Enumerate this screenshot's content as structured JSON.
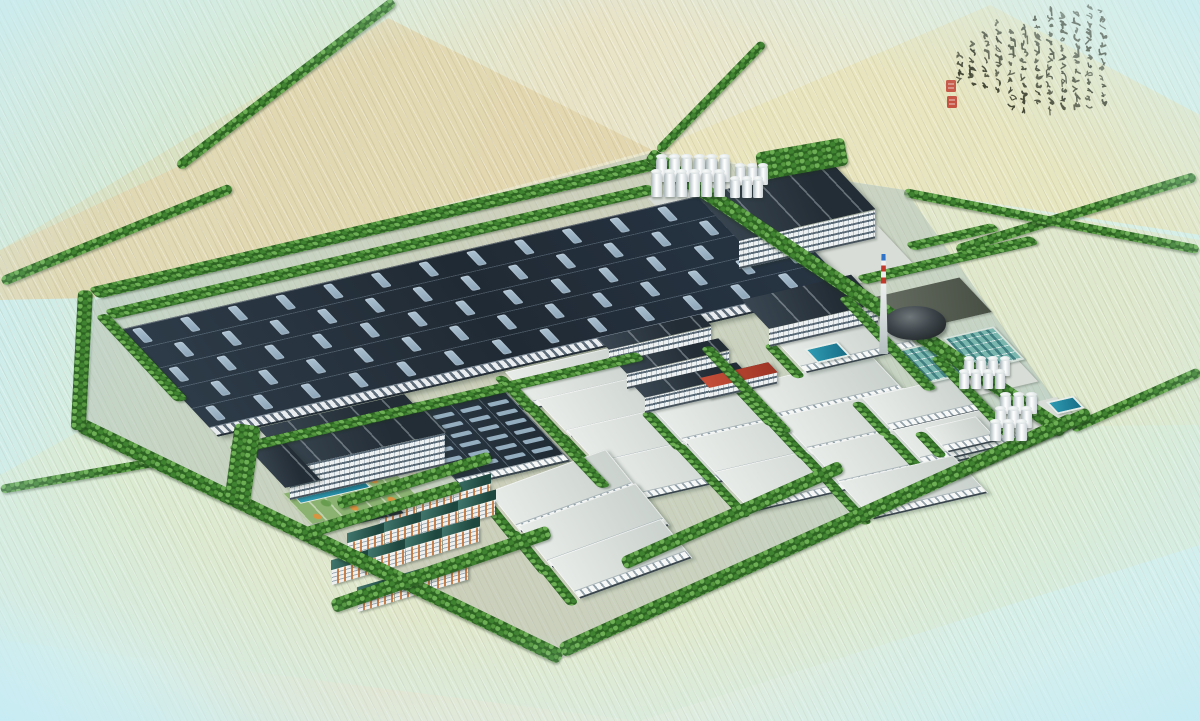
{
  "scene": {
    "title": "Industrial park master-plan aerial rendering",
    "medium": "hand-tinted architectural perspective over hatched farmland",
    "palette": {
      "sky_edge": "#c7ecf3",
      "field_beige": "#e2d5ac",
      "field_green": "#dbead0",
      "tree_light": "#6db054",
      "tree_dark": "#2d6323",
      "roof_dark": "#232d38",
      "skylight": "#9db6c8",
      "roof_light": "#dde2de",
      "wall_white": "#eef1f2",
      "water_teal": "#2f9cb4",
      "basin_teal": "#79b7ae",
      "chimney_red": "#c0392b",
      "chimney_blue": "#2e73c8",
      "accent_red": "#b8432c",
      "residential_roof": "#1e473f",
      "residential_accent": "#c6763a",
      "seal_red": "#c0392b",
      "ink": "#32321e"
    },
    "inscription": {
      "type": "cursive Chinese calligraphy (decorative, illegible)",
      "column_count": 12,
      "seal_count": 2,
      "seal_color": "#c0392b",
      "ink_color": "#32321e"
    }
  },
  "site": {
    "description": "tree-lined industrial plot with radiating field roads",
    "roads": [
      {
        "x": 0,
        "y": 277,
        "w": 248,
        "h": 10,
        "r": -22.2
      },
      {
        "x": 175,
        "y": 163,
        "w": 272,
        "h": 10,
        "r": -37.5
      },
      {
        "x": 955,
        "y": 245,
        "w": 250,
        "h": 10,
        "r": -17
      },
      {
        "x": 905,
        "y": 188,
        "w": 300,
        "h": 9,
        "r": 11
      },
      {
        "x": 1070,
        "y": 424,
        "w": 140,
        "h": 10,
        "r": -24
      },
      {
        "x": 0,
        "y": 485,
        "w": 165,
        "h": 9,
        "r": -10
      },
      {
        "x": 655,
        "y": 148,
        "w": 151,
        "h": 9,
        "r": -45.8
      }
    ],
    "tree_strips": [
      {
        "x": 88,
        "y": 288,
        "w": 578,
        "h": 15,
        "m": "iso"
      },
      {
        "x": 653,
        "y": 148,
        "w": 500,
        "h": 15,
        "r": 33.7
      },
      {
        "x": 558,
        "y": 644,
        "w": 562,
        "h": 15,
        "r": -24.3
      },
      {
        "x": 83,
        "y": 418,
        "w": 535,
        "h": 15,
        "r": 25.8
      },
      {
        "x": 78,
        "y": 290,
        "w": 15,
        "h": 140,
        "r": 3
      },
      {
        "x": 104,
        "y": 310,
        "w": 560,
        "h": 13,
        "m": "iso"
      },
      {
        "x": 95,
        "y": 316,
        "w": 13,
        "h": 120,
        "m": "iso"
      },
      {
        "x": 228,
        "y": 446,
        "w": 420,
        "h": 12,
        "m": "iso"
      },
      {
        "x": 505,
        "y": 388,
        "w": 12,
        "h": 140,
        "m": "iso"
      },
      {
        "x": 838,
        "y": 298,
        "w": 12,
        "h": 130,
        "m": "iso"
      },
      {
        "x": 856,
        "y": 276,
        "w": 180,
        "h": 12,
        "m": "iso"
      },
      {
        "x": 930,
        "y": 358,
        "w": 12,
        "h": 110,
        "m": "iso"
      },
      {
        "x": 950,
        "y": 468,
        "w": 150,
        "h": 13,
        "r": -24
      },
      {
        "x": 620,
        "y": 558,
        "w": 240,
        "h": 13,
        "r": -24
      },
      {
        "x": 336,
        "y": 498,
        "w": 160,
        "h": 12,
        "r": -17
      },
      {
        "x": 330,
        "y": 600,
        "w": 230,
        "h": 14,
        "r": -19
      },
      {
        "x": 700,
        "y": 348,
        "w": 12,
        "h": 120,
        "m": "iso"
      },
      {
        "x": 905,
        "y": 243,
        "w": 90,
        "h": 11,
        "m": "iso"
      },
      {
        "x": 755,
        "y": 153,
        "w": 90,
        "h": 28,
        "r": -10
      },
      {
        "x": 235,
        "y": 423,
        "w": 26,
        "h": 80,
        "r": 8
      },
      {
        "x": 296,
        "y": 530,
        "w": 170,
        "h": 12,
        "r": -17
      }
    ],
    "pads": [
      {
        "x": 648,
        "y": 198,
        "w": 102,
        "h": 40
      },
      {
        "x": 760,
        "y": 252,
        "w": 120,
        "h": 62
      },
      {
        "x": 862,
        "y": 300,
        "w": 100,
        "h": 48,
        "dark": true
      },
      {
        "x": 958,
        "y": 372,
        "w": 60,
        "h": 32
      },
      {
        "x": 992,
        "y": 412,
        "w": 66,
        "h": 36
      }
    ],
    "warehouses": [
      {
        "x": 505,
        "y": 372,
        "w": 130,
        "h": 50,
        "m": "iso"
      },
      {
        "x": 536,
        "y": 400,
        "w": 130,
        "h": 52,
        "m": "iso"
      },
      {
        "x": 566,
        "y": 430,
        "w": 135,
        "h": 54,
        "m": "iso"
      },
      {
        "x": 596,
        "y": 462,
        "w": 138,
        "h": 56,
        "m": "iso"
      },
      {
        "x": 652,
        "y": 408,
        "w": 135,
        "h": 52,
        "m": "iso"
      },
      {
        "x": 684,
        "y": 440,
        "w": 138,
        "h": 54,
        "m": "iso"
      },
      {
        "x": 714,
        "y": 472,
        "w": 140,
        "h": 56,
        "m": "iso"
      },
      {
        "x": 745,
        "y": 385,
        "w": 130,
        "h": 50,
        "m": "iso"
      },
      {
        "x": 777,
        "y": 417,
        "w": 130,
        "h": 52,
        "m": "iso"
      },
      {
        "x": 808,
        "y": 449,
        "w": 130,
        "h": 54,
        "m": "iso"
      },
      {
        "x": 775,
        "y": 340,
        "w": 115,
        "h": 46,
        "m": "iso"
      },
      {
        "x": 862,
        "y": 398,
        "w": 100,
        "h": 46,
        "m": "iso"
      },
      {
        "x": 893,
        "y": 430,
        "w": 100,
        "h": 48,
        "m": "iso"
      },
      {
        "x": 838,
        "y": 482,
        "w": 118,
        "h": 52,
        "m": "iso"
      },
      {
        "x": 925,
        "y": 428,
        "w": 52,
        "h": 34,
        "m": "iso"
      },
      {
        "x": 488,
        "y": 492,
        "w": 125,
        "h": 52,
        "m": "iso2"
      },
      {
        "x": 518,
        "y": 526,
        "w": 125,
        "h": 54,
        "m": "iso2"
      },
      {
        "x": 548,
        "y": 560,
        "w": 120,
        "h": 50,
        "m": "iso2"
      }
    ],
    "big_workshop": {
      "x": 118,
      "y": 330,
      "w": 650,
      "h": 148,
      "skylight_rows": 5,
      "skylight_cols": 13
    },
    "grid_workshop": {
      "x": 390,
      "y": 410,
      "w": 112,
      "h": 106,
      "bays": 4,
      "skylights_per_bay": 7
    },
    "slab_buildings": [
      {
        "name": "north-office",
        "roof": [
          697,
          196,
          140,
          62
        ],
        "wall": [
          739,
          241,
          136,
          26
        ],
        "skew": "s13",
        "red": false
      },
      {
        "name": "boiler-house",
        "roof": [
          742,
          300,
          112,
          40
        ],
        "wall": [
          769,
          329,
          109,
          16
        ],
        "skew": "s13",
        "red": false
      },
      {
        "name": "mid-workshop-1",
        "roof": [
          598,
          338,
          105,
          16
        ],
        "wall": [
          609,
          350,
          102,
          13
        ],
        "skew": "s13",
        "red": false
      },
      {
        "name": "mid-workshop-2",
        "roof": [
          616,
          362,
          105,
          16
        ],
        "wall": [
          627,
          374,
          102,
          13
        ],
        "skew": "s13",
        "red": false
      },
      {
        "name": "mid-workshop-3",
        "roof": [
          634,
          386,
          105,
          16
        ],
        "wall": [
          645,
          398,
          102,
          13
        ],
        "skew": "s13",
        "red": false
      },
      {
        "name": "red-curved-building",
        "roof": [
          700,
          378,
          70,
          14
        ],
        "wall": [
          709,
          388,
          68,
          9
        ],
        "skew": "s13",
        "red": true
      },
      {
        "name": "admin-back-wing",
        "roof": [
          258,
          428,
          150,
          16
        ],
        "wall": [
          269,
          440,
          145,
          18
        ],
        "skew": "s13",
        "red": false
      },
      {
        "name": "admin-main-block",
        "roof": [
          262,
          438,
          160,
          42
        ],
        "wall": [
          290,
          468,
          155,
          30
        ],
        "skew": "s13",
        "red": false
      },
      {
        "name": "admin-side-wing",
        "roof": [
          246,
          446,
          36,
          58
        ],
        "wall": null,
        "skew": "s13",
        "red": false
      }
    ],
    "silo_groups": [
      {
        "x": 656,
        "y": 156,
        "cols": 6,
        "rows": 2,
        "dx": 12.5,
        "dy": 15,
        "ox": -5,
        "w": 11,
        "h": 26
      },
      {
        "x": 735,
        "y": 165,
        "cols": 3,
        "rows": 2,
        "dx": 11.5,
        "dy": 13,
        "ox": -5,
        "w": 10,
        "h": 20
      }
    ],
    "tank_groups": [
      {
        "x": 964,
        "y": 358,
        "cols": 4,
        "rows": 2,
        "dx": 12,
        "dy": 13,
        "ox": -5,
        "w": 10,
        "h": 18
      },
      {
        "x": 1000,
        "y": 394,
        "cols": 3,
        "rows": 3,
        "dx": 13,
        "dy": 13.5,
        "ox": -5,
        "w": 11,
        "h": 20
      }
    ],
    "basins": [
      {
        "x": 890,
        "y": 352,
        "w": 48,
        "h": 42
      },
      {
        "x": 943,
        "y": 338,
        "w": 48,
        "h": 42
      }
    ],
    "pools": [
      {
        "x": 804,
        "y": 349,
        "w": 30,
        "h": 16
      },
      {
        "x": 1046,
        "y": 402,
        "w": 24,
        "h": 13
      }
    ],
    "chimney": {
      "x": 878,
      "y": 254,
      "w": 11,
      "h": 100
    },
    "coal_pile": {
      "x": 884,
      "y": 306,
      "w": 62,
      "h": 34
    },
    "residential": {
      "dx": 37,
      "dy": -11,
      "unit_w": 36,
      "rows": [
        {
          "x": 380,
          "y": 516,
          "n": 3
        },
        {
          "x": 348,
          "y": 543,
          "n": 4
        },
        {
          "x": 332,
          "y": 570,
          "n": 4
        },
        {
          "x": 358,
          "y": 597,
          "n": 3
        }
      ]
    },
    "admin": {
      "courtyard": [
        282,
        494,
        180,
        42
      ],
      "gate": [
        350,
        514,
        46,
        13
      ]
    },
    "corridor": [
      436,
      424,
      260,
      7
    ],
    "calligraphy": {
      "columns": [
        [
          158,
          8,
          12
        ],
        [
          145,
          4,
          13
        ],
        [
          132,
          10,
          12
        ],
        [
          119,
          12,
          12
        ],
        [
          106,
          6,
          13
        ],
        [
          93,
          16,
          11
        ],
        [
          80,
          24,
          11
        ],
        [
          67,
          28,
          10
        ],
        [
          54,
          20,
          9
        ],
        [
          41,
          32,
          7
        ],
        [
          28,
          40,
          6
        ],
        [
          15,
          52,
          4
        ]
      ],
      "seals": [
        [
          6,
          80
        ],
        [
          7,
          96
        ]
      ]
    }
  }
}
